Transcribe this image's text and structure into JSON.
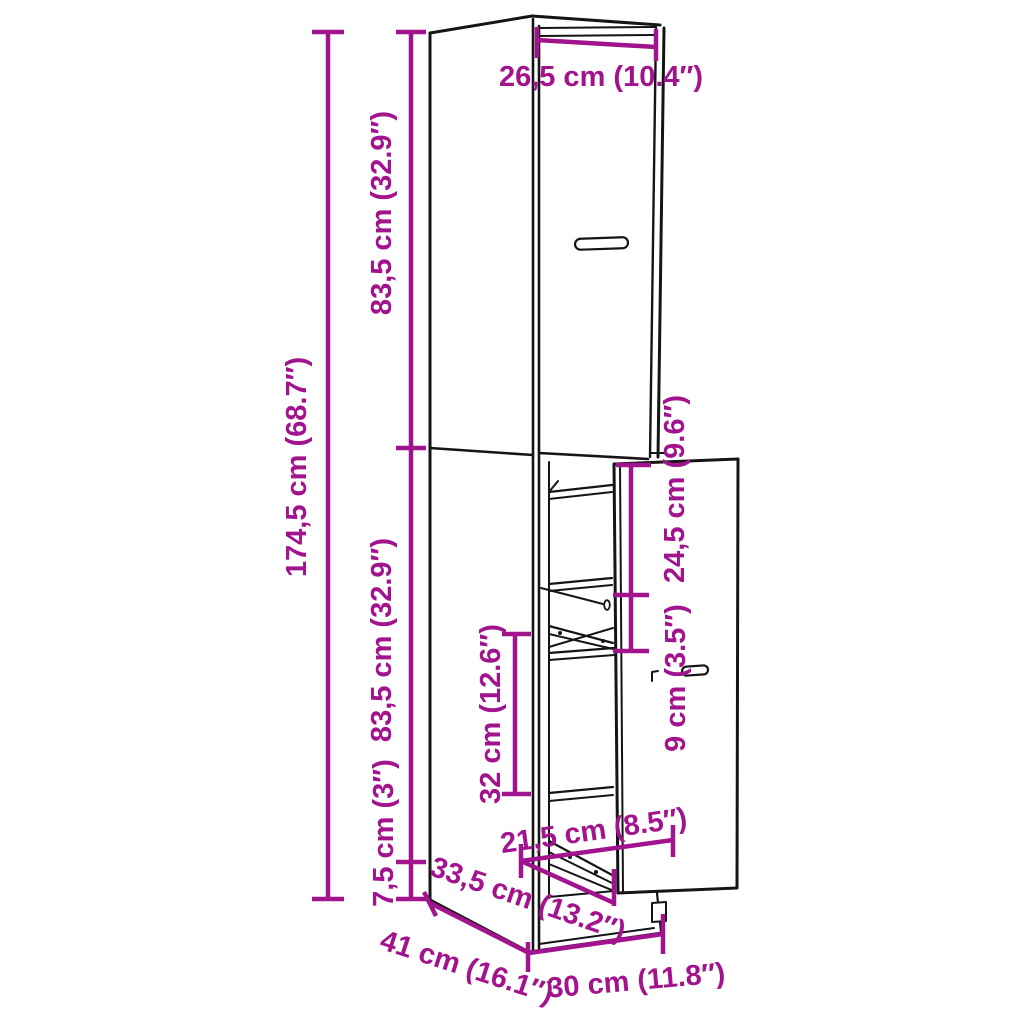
{
  "colors": {
    "accent": "#A2138E",
    "line": "#151515",
    "background": "#FFFFFF"
  },
  "dimensions": {
    "top_width": "26,5 cm (10.4″)",
    "upper_section_height": "83,5 cm (32.9″)",
    "total_height": "174,5 cm (68.7″)",
    "lower_section_height": "83,5 cm (32.9″)",
    "plinth_height": "7,5 cm (3″)",
    "pullout_top_clearance": "24,5 cm (9.6″)",
    "basket_height": "9 cm (3.5″)",
    "shelf_clearance": "32 cm (12.6″)",
    "pullout_extension": "21,5 cm (8.5″)",
    "pullout_depth": "33,5 cm (13.2″)",
    "cabinet_depth": "41 cm (16.1″)",
    "cabinet_width": "30 cm (11.8″)"
  }
}
